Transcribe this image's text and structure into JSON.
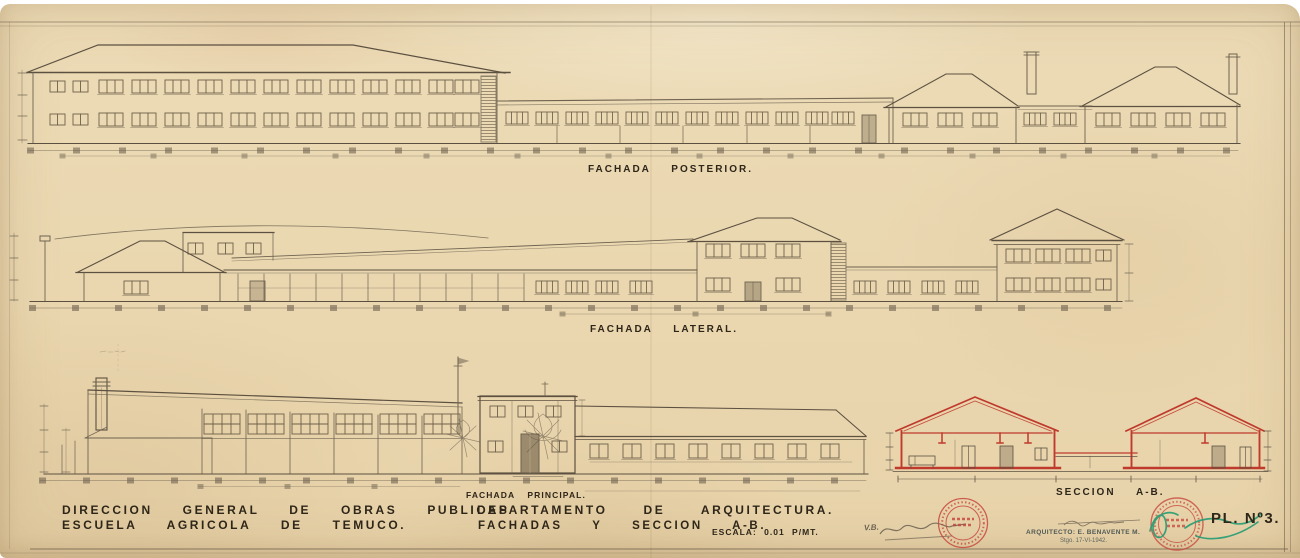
{
  "drawing": {
    "organization_line1": "DIRECCION GENERAL DE OBRAS PUBLICAS",
    "organization_line2": "ESCUELA AGRICOLA DE TEMUCO.",
    "department_line1": "DEPARTAMENTO DE ARQUITECTURA.",
    "department_line2": "FACHADAS Y SECCION A-B.",
    "scale_note": "ESCALA: 0.01 P/MT.",
    "plate_number": "PL. Nº3.",
    "architect_line": "ARQUITECTO: E. BENAVENTE M.",
    "architect_date": "Stgo. 17-VI-1942.",
    "approval_initials": "V.B.",
    "labels": {
      "posterior": "FACHADA POSTERIOR.",
      "lateral": "FACHADA LATERAL.",
      "principal": "FACHADA PRINCIPAL.",
      "seccion": "SECCION A-B."
    },
    "colors": {
      "paper": "#ebd8b2",
      "pencil": "#7a6c55",
      "ink": "#2e2619",
      "stamp_red": "#c5443a",
      "signature_green": "#2a9d74"
    }
  }
}
